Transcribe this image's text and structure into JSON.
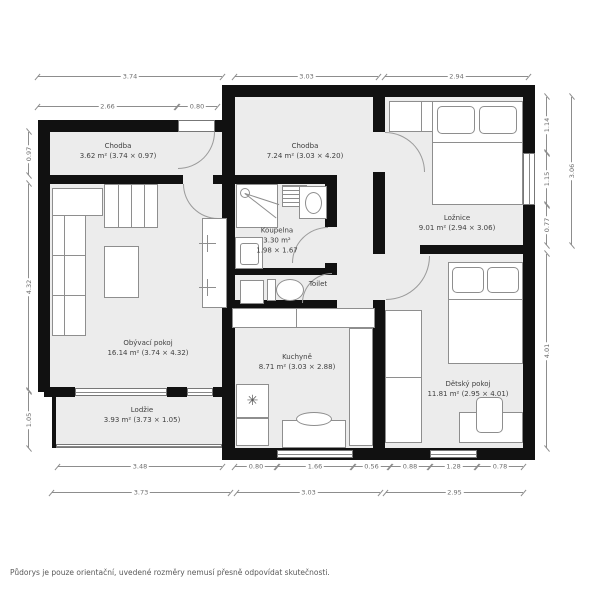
{
  "plan": {
    "rooms": [
      {
        "id": "chodba-top",
        "name": "Chodba",
        "area": "3.62 m² (3.74 × 0.97)"
      },
      {
        "id": "chodba-main",
        "name": "Chodba",
        "area": "7.24 m² (3.03 × 4.20)"
      },
      {
        "id": "loznice",
        "name": "Ložnice",
        "area": "9.01 m² (2.94 × 3.06)"
      },
      {
        "id": "koupelna",
        "name": "Koupelna",
        "area": "3.30 m²",
        "size": "1.98 × 1.67"
      },
      {
        "id": "toilet",
        "name": "Toilet",
        "area": ""
      },
      {
        "id": "obyvaci-pokoj",
        "name": "Obývací pokoj",
        "area": "16.14 m² (3.74 × 4.32)"
      },
      {
        "id": "kuchyne",
        "name": "Kuchyně",
        "area": "8.71 m² (3.03 × 2.88)"
      },
      {
        "id": "detsky-pokoj",
        "name": "Dětský pokoj",
        "area": "11.81 m² (2.95 × 4.01)"
      },
      {
        "id": "lodzie",
        "name": "Lodžie",
        "area": "3.93 m² (3.73 × 1.05)"
      }
    ],
    "dimensions": {
      "top": [
        "3.74",
        "3.03",
        "2.94"
      ],
      "top_sub": [
        "2.66",
        "0.80"
      ],
      "left": [
        "0.97",
        "4.32",
        "1.05"
      ],
      "right_inner": [
        "1.14",
        "1.15",
        "0.77"
      ],
      "right_outer": [
        "3.06",
        "4.01"
      ],
      "bottom_sub": [
        "3.48",
        "0.80",
        "1.66",
        "0.56",
        "0.88",
        "1.28",
        "0.78"
      ],
      "bottom": [
        "3.73",
        "3.03",
        "2.95"
      ]
    },
    "icons": {
      "snowflake": "✳"
    },
    "colors": {
      "wall": "#111111",
      "floor": "#ececec",
      "outline": "#8e8e8e",
      "dimension": "#8d8d8d",
      "label": "#3f3f3f"
    },
    "disclaimer": "Půdorys je pouze orientační, uvedené rozměry nemusí přesně odpovídat skutečnosti."
  }
}
